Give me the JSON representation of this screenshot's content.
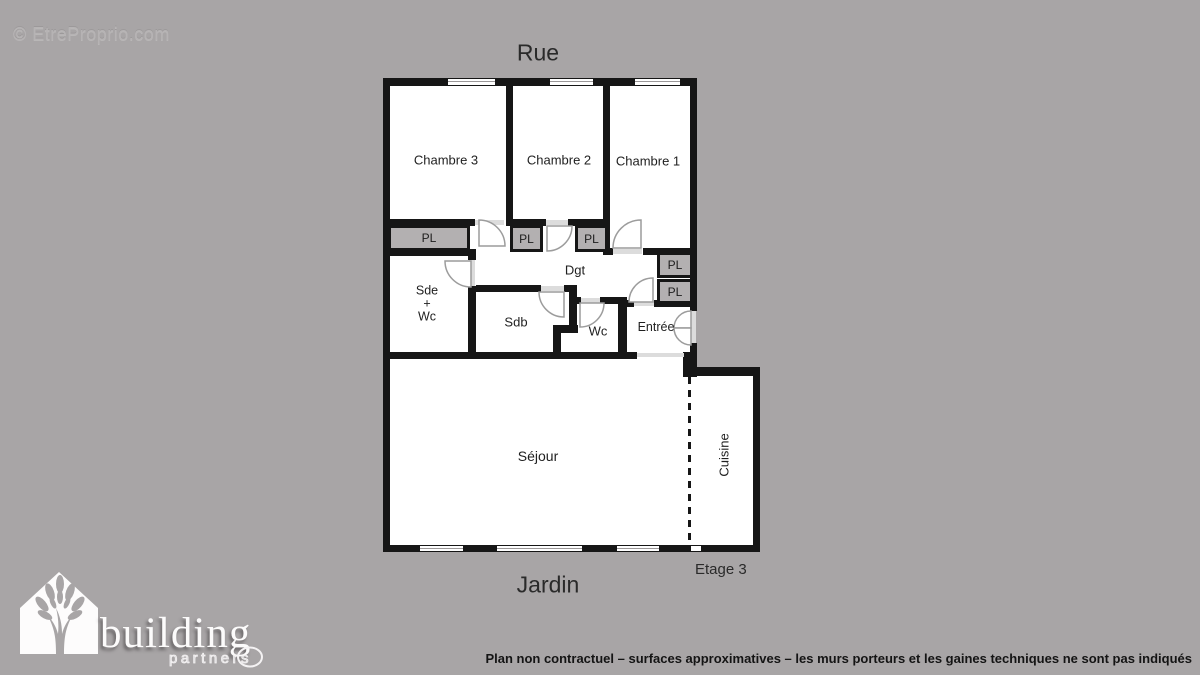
{
  "watermark": "© EtreProprio.com",
  "labels": {
    "street_side": "Rue",
    "garden_side": "Jardin",
    "floor": "Etage 3"
  },
  "rooms": {
    "chambre3": "Chambre 3",
    "chambre2": "Chambre 2",
    "chambre1": "Chambre 1",
    "degagement": "Dgt",
    "sde_line1": "Sde",
    "sde_line2": "+",
    "sde_line3": "Wc",
    "sdb": "Sdb",
    "wc": "Wc",
    "entree": "Entrée",
    "sejour": "Séjour",
    "cuisine": "Cuisine"
  },
  "closets": [
    "PL",
    "PL",
    "PL",
    "PL",
    "PL"
  ],
  "logo": {
    "brand": "building",
    "tagline": "partners"
  },
  "footer": {
    "disclaimer": "Plan non contractuel – surfaces approximatives – les murs porteurs et les gaines techniques ne sont pas indiqués"
  },
  "colors": {
    "background": "#a8a5a6",
    "wall": "#161616",
    "floor": "#ffffff",
    "closet_fill": "#b3b0b1",
    "text": "#1f1f1f"
  }
}
